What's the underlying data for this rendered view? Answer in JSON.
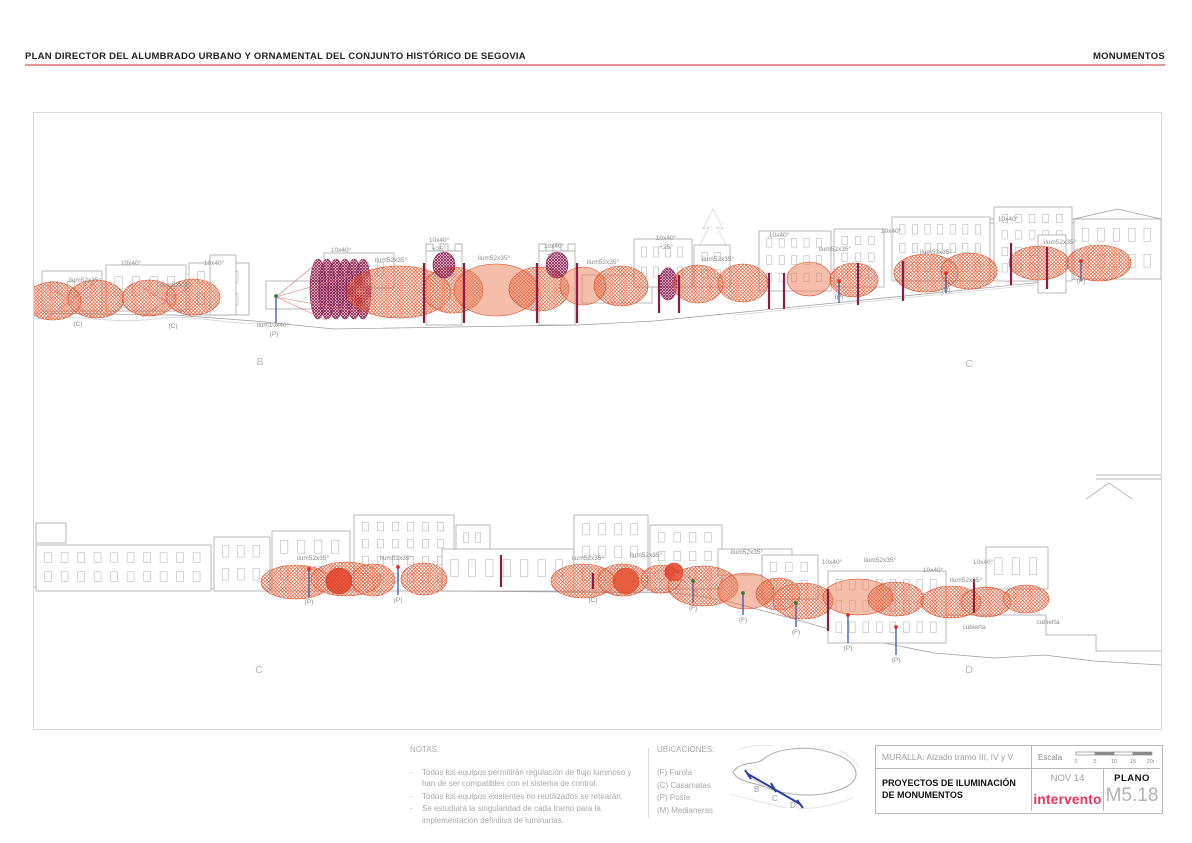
{
  "header": {
    "title": "PLAN DIRECTOR DEL ALUMBRADO URBANO Y ORNAMENTAL DEL CONJUNTO HISTÓRICO DE SEGOVIA",
    "right": "MONUMENTOS"
  },
  "footer": {
    "notas": {
      "title": "NOTAS:",
      "bullet": "-",
      "items": [
        "Todos los equipos permitirán regulación de flujo luminoso y han de ser compatibles con el sistema de control.",
        "Todos los equipos existentes no reutilizados se retirarán.",
        "Se estudiará la singularidad de cada tramo para la implementación definitiva de luminarias."
      ]
    },
    "ubicaciones": {
      "title": "UBICACIONES:",
      "items": [
        "(F) Farola",
        "(C) Casamatas",
        "(P) Poste",
        "(M) Medianeras"
      ],
      "map_labels": [
        "B",
        "C",
        "D"
      ]
    },
    "titleblock": {
      "subtitle": "MURALLA: Alzado tramo III, IV y V",
      "escala_label": "Escala",
      "scale_ticks": [
        "0",
        "5",
        "10",
        "15",
        "20m"
      ],
      "project": "PROYECTOS DE ILUMINACIÓN DE MONUMENTOS",
      "date": "NOV 14",
      "logo": "intervento",
      "plano_label": "PLANO",
      "plano_number": "M5.18"
    }
  },
  "drawing": {
    "colors": {
      "line": "#9c9c9c",
      "light": "#cfcfcf",
      "label": "#8a8a8a",
      "letter": "#b8b8b8",
      "maroon": "#8e1b41",
      "blue": "#3a57a8",
      "green": "#2e7d32",
      "red": "#d83025",
      "redline": "#e57373"
    },
    "styles": {
      "h": {
        "f": "url(#hatchO)",
        "s": "#da4b27",
        "o": 1
      },
      "f": {
        "f": "#ef7c57",
        "s": "#da4b27",
        "o": 0.5
      },
      "p": {
        "f": "url(#hatchP)",
        "s": "#8d2050",
        "o": 1
      },
      "r": {
        "f": "#e04027",
        "s": "#c43a22",
        "o": 0.85
      }
    },
    "panel1": {
      "light": [
        "M2,206 C40,200 80,212 120,206 C160,200 200,214 240,210",
        "M700,202 C800,192 900,182 1000,172",
        "M679,96 L669,116 L675,114 L665,134 L672,132 L662,152 L670,150 L660,170 L698,170 L688,150 L696,152 L686,132 L693,134 L683,114 L689,116 Z"
      ],
      "paths": [
        "M0,200 L140,202 L220,208 L260,212 L300,216 L420,214 L545,212 L620,208 L700,200 L800,190 L900,180 L1000,170 L1127,158",
        "M917,106 L1127,106 M917,110 L1127,110",
        "M392,138 v-7 h7 v7 h7 v-7 h8 v7 h7 v-7 h7 v7",
        "M505,138 v-7 h7 v7 h7 v-7 h8 v7 h7 v-7 h7 v7",
        "M556,162 v28 M566,162 v28 M576,162 v28 M586,162 v28 M596,162 v28 M606,162 v28"
      ],
      "buildings": [
        [
          8,
          158,
          60,
          40,
          1,
          3
        ],
        [
          72,
          152,
          80,
          46,
          1,
          4
        ],
        [
          155,
          150,
          60,
          52,
          2,
          3
        ],
        [
          176,
          142,
          26,
          60,
          0,
          0
        ],
        [
          232,
          168,
          55,
          28,
          0,
          0
        ],
        [
          290,
          140,
          70,
          35,
          1,
          4
        ],
        [
          392,
          138,
          36,
          74,
          0,
          0
        ],
        [
          505,
          138,
          36,
          74,
          0,
          0
        ],
        [
          548,
          162,
          70,
          28,
          0,
          0
        ],
        [
          600,
          126,
          58,
          48,
          2,
          4
        ],
        [
          660,
          132,
          36,
          42,
          2,
          2
        ],
        [
          725,
          118,
          72,
          60,
          3,
          5
        ],
        [
          800,
          116,
          50,
          58,
          3,
          3
        ],
        [
          858,
          104,
          98,
          64,
          3,
          7
        ],
        [
          960,
          94,
          78,
          74,
          4,
          5
        ],
        [
          1004,
          122,
          28,
          58,
          0,
          0
        ],
        [
          1040,
          106,
          87,
          60,
          2,
          5,
          10
        ]
      ],
      "ellipses": [
        [
          19,
          188,
          28,
          19,
          "h"
        ],
        [
          62,
          186,
          28,
          19,
          "h"
        ],
        [
          115,
          185,
          27,
          18,
          "h"
        ],
        [
          159,
          184,
          27,
          18,
          "h"
        ],
        [
          284,
          176,
          8,
          30,
          "p"
        ],
        [
          293,
          176,
          8,
          30,
          "p"
        ],
        [
          302,
          176,
          8,
          30,
          "p"
        ],
        [
          311,
          176,
          8,
          30,
          "p"
        ],
        [
          320,
          176,
          8,
          30,
          "p"
        ],
        [
          329,
          176,
          8,
          30,
          "p"
        ],
        [
          365,
          179,
          52,
          26,
          "h"
        ],
        [
          419,
          177,
          30,
          23,
          "h"
        ],
        [
          462,
          177,
          42,
          26,
          "f"
        ],
        [
          505,
          176,
          30,
          22,
          "h"
        ],
        [
          410,
          152,
          11,
          13,
          "p"
        ],
        [
          523,
          152,
          11,
          13,
          "p"
        ],
        [
          549,
          173,
          23,
          19,
          "f"
        ],
        [
          587,
          173,
          27,
          20,
          "h"
        ],
        [
          634,
          171,
          9,
          16,
          "p"
        ],
        [
          664,
          171,
          25,
          19,
          "h"
        ],
        [
          709,
          170,
          25,
          19,
          "h"
        ],
        [
          775,
          166,
          22,
          17,
          "f"
        ],
        [
          820,
          167,
          24,
          17,
          "h"
        ],
        [
          892,
          160,
          32,
          19,
          "h"
        ],
        [
          935,
          158,
          28,
          18,
          "h"
        ],
        [
          1005,
          150,
          30,
          17,
          "h"
        ],
        [
          1065,
          150,
          32,
          18,
          "h"
        ]
      ],
      "redlines": [
        [
          13,
          205,
          60,
          170
        ],
        [
          60,
          205,
          13,
          172
        ],
        [
          108,
          204,
          158,
          172
        ],
        [
          158,
          204,
          108,
          174
        ],
        [
          242,
          184,
          283,
          150
        ],
        [
          242,
          184,
          292,
          207
        ],
        [
          242,
          184,
          318,
          162
        ],
        [
          242,
          184,
          330,
          200
        ]
      ],
      "posts": [
        [
          390,
          150,
          210,
          "maroon"
        ],
        [
          430,
          150,
          210,
          "maroon"
        ],
        [
          503,
          150,
          210,
          "maroon"
        ],
        [
          543,
          150,
          210,
          "maroon"
        ],
        [
          625,
          162,
          200,
          "maroon"
        ],
        [
          645,
          162,
          200,
          "maroon"
        ],
        [
          735,
          160,
          196,
          "maroon"
        ],
        [
          750,
          160,
          196,
          "maroon"
        ],
        [
          824,
          150,
          192,
          "maroon"
        ],
        [
          869,
          148,
          188,
          "maroon"
        ],
        [
          977,
          130,
          172,
          "maroon"
        ],
        [
          1013,
          134,
          176,
          "maroon"
        ],
        [
          242,
          183,
          210,
          "blue",
          "green"
        ],
        [
          805,
          168,
          190,
          "blue",
          "red"
        ],
        [
          912,
          160,
          180,
          "blue",
          "red"
        ],
        [
          1047,
          148,
          168,
          "blue",
          "red"
        ]
      ],
      "labels": [
        {
          "t": "ilum52x35°",
          "x": 51,
          "y": 169
        },
        {
          "t": "(C)",
          "x": 44,
          "y": 213
        },
        {
          "t": "10x40°",
          "x": 97,
          "y": 152
        },
        {
          "t": "ilum52x35°",
          "x": 142,
          "y": 174
        },
        {
          "t": "(C)",
          "x": 139,
          "y": 215
        },
        {
          "t": "10x40°",
          "x": 180,
          "y": 152
        },
        {
          "t": "ilum10x40°",
          "x": 239,
          "y": 214
        },
        {
          "t": "(P)",
          "x": 240,
          "y": 223
        },
        {
          "t": "10x40°",
          "x": 307,
          "y": 139
        },
        {
          "t": "ilum52x35°",
          "x": 357,
          "y": 149
        },
        {
          "t": "10x40°",
          "x": 405,
          "y": 129
        },
        {
          "t": "+25°",
          "x": 405,
          "y": 138
        },
        {
          "t": "ilum52x35°",
          "x": 460,
          "y": 147
        },
        {
          "t": "10x40°",
          "x": 520,
          "y": 135
        },
        {
          "t": "+25°",
          "x": 520,
          "y": 144
        },
        {
          "t": "ilum52x35°",
          "x": 569,
          "y": 151
        },
        {
          "t": "10x40°",
          "x": 632,
          "y": 127
        },
        {
          "t": "+25°",
          "x": 632,
          "y": 136
        },
        {
          "t": "ilum52x35°",
          "x": 684,
          "y": 148
        },
        {
          "t": "10x40°",
          "x": 745,
          "y": 124
        },
        {
          "t": "ilum52x35°",
          "x": 801,
          "y": 138
        },
        {
          "t": "(P)",
          "x": 805,
          "y": 186
        },
        {
          "t": "10x40°",
          "x": 857,
          "y": 120
        },
        {
          "t": "ilum52x35°",
          "x": 902,
          "y": 141
        },
        {
          "t": "(P)",
          "x": 912,
          "y": 179
        },
        {
          "t": "10x40°",
          "x": 974,
          "y": 108
        },
        {
          "t": "ilum52x35°",
          "x": 1026,
          "y": 131
        },
        {
          "t": "(P)",
          "x": 1047,
          "y": 170
        }
      ],
      "letters": [
        {
          "t": "B",
          "x": 226,
          "y": 252
        },
        {
          "t": "C",
          "x": 935,
          "y": 254
        }
      ]
    },
    "panel2": {
      "light": [
        "M4,176 C30,168 60,180 90,172 C120,166 150,180 178,174",
        "M240,182 C270,174 300,186 330,180",
        "M540,182 C560,176 580,186 600,180"
      ],
      "paths": [
        "M0,184 L200,186 L420,188 L640,190 L665,193 L700,200 L760,216 L830,236 L900,250 L960,255 L1010,252 L1060,258 L1127,262",
        "M420,152 v30 M436,152 v30 M452,152 v30 M468,152 v30 M484,152 v30 M500,152 v30 M516,152 v30",
        "M692,146 v26 M702,146 v26 M712,146 v26 M722,146 v26 M732,146 v26 M742,146 v26 M752,146 v26",
        "M878,212 L1012,212 M1012,212 L1012,232 L1062,232 L1062,248 L1127,248",
        "M1062,72 L1127,72 M1062,76 L1127,76",
        "M1052,96 L1075,80 L1098,96"
      ],
      "buildings": [
        [
          2,
          120,
          30,
          20,
          0,
          0
        ],
        [
          2,
          142,
          175,
          46,
          2,
          10
        ],
        [
          180,
          134,
          56,
          54,
          2,
          3
        ],
        [
          238,
          128,
          78,
          60,
          2,
          4
        ],
        [
          320,
          112,
          100,
          76,
          4,
          6
        ],
        [
          422,
          122,
          34,
          66,
          3,
          2
        ],
        [
          408,
          146,
          132,
          42,
          1,
          7
        ],
        [
          540,
          112,
          74,
          76,
          3,
          4
        ],
        [
          616,
          122,
          72,
          64,
          3,
          4
        ],
        [
          684,
          146,
          74,
          26,
          0,
          0
        ],
        [
          728,
          152,
          56,
          44,
          2,
          3
        ],
        [
          794,
          168,
          118,
          72,
          3,
          8
        ],
        [
          952,
          144,
          62,
          42,
          1,
          3
        ]
      ],
      "ellipses": [
        [
          262,
          179,
          35,
          17,
          "h"
        ],
        [
          312,
          176,
          35,
          17,
          "h"
        ],
        [
          305,
          178,
          13,
          13,
          "r"
        ],
        [
          339,
          177,
          22,
          16,
          "h"
        ],
        [
          390,
          176,
          23,
          16,
          "h"
        ],
        [
          549,
          178,
          32,
          17,
          "h"
        ],
        [
          592,
          178,
          13,
          13,
          "r"
        ],
        [
          589,
          177,
          25,
          16,
          "h"
        ],
        [
          627,
          176,
          20,
          14,
          "h"
        ],
        [
          640,
          169,
          9,
          9,
          "r"
        ],
        [
          669,
          183,
          35,
          20,
          "h"
        ],
        [
          712,
          188,
          28,
          18,
          "f"
        ],
        [
          744,
          191,
          22,
          16,
          "h"
        ],
        [
          769,
          198,
          30,
          18,
          "h"
        ],
        [
          824,
          194,
          35,
          18,
          "f"
        ],
        [
          862,
          196,
          28,
          17,
          "h"
        ],
        [
          917,
          199,
          30,
          16,
          "h"
        ],
        [
          952,
          199,
          25,
          15,
          "h"
        ],
        [
          992,
          196,
          23,
          14,
          "h"
        ]
      ],
      "redlines": [
        [
          640,
          170,
          668,
          178
        ],
        [
          640,
          170,
          664,
          190
        ]
      ],
      "posts": [
        [
          467,
          152,
          184,
          "maroon"
        ],
        [
          559,
          170,
          186,
          "maroon"
        ],
        [
          794,
          186,
          228,
          "maroon"
        ],
        [
          940,
          176,
          210,
          "maroon"
        ],
        [
          275,
          166,
          194,
          "blue",
          "red"
        ],
        [
          364,
          164,
          192,
          "blue",
          "red"
        ],
        [
          659,
          178,
          200,
          "blue",
          "green"
        ],
        [
          709,
          190,
          212,
          "blue",
          "green"
        ],
        [
          762,
          200,
          224,
          "blue",
          "green"
        ],
        [
          814,
          212,
          240,
          "blue",
          "red"
        ],
        [
          862,
          224,
          252,
          "blue",
          "red"
        ]
      ],
      "labels": [
        {
          "t": "ilum52x35°",
          "x": 279,
          "y": 157
        },
        {
          "t": "(P)",
          "x": 275,
          "y": 201
        },
        {
          "t": "ilum52x35°",
          "x": 362,
          "y": 157
        },
        {
          "t": "(P)",
          "x": 364,
          "y": 199
        },
        {
          "t": "ilum52x35°",
          "x": 554,
          "y": 157
        },
        {
          "t": "(C)",
          "x": 559,
          "y": 199
        },
        {
          "t": "ilum52x35°",
          "x": 612,
          "y": 154
        },
        {
          "t": "ilum52x35°",
          "x": 713,
          "y": 151
        },
        {
          "t": "(F)",
          "x": 659,
          "y": 207
        },
        {
          "t": "(F)",
          "x": 709,
          "y": 219
        },
        {
          "t": "(F)",
          "x": 762,
          "y": 231
        },
        {
          "t": "10x40°",
          "x": 798,
          "y": 161
        },
        {
          "t": "ilum52x35°",
          "x": 846,
          "y": 159
        },
        {
          "t": "(P)",
          "x": 814,
          "y": 247
        },
        {
          "t": "(P)",
          "x": 862,
          "y": 259
        },
        {
          "t": "10x40°",
          "x": 899,
          "y": 169
        },
        {
          "t": "ilum52x35°",
          "x": 932,
          "y": 179
        },
        {
          "t": "10x40°",
          "x": 949,
          "y": 161
        },
        {
          "t": "cubierta",
          "x": 940,
          "y": 226
        },
        {
          "t": "cubierta",
          "x": 1014,
          "y": 221
        }
      ],
      "letters": [
        {
          "t": "C",
          "x": 225,
          "y": 270
        },
        {
          "t": "D",
          "x": 935,
          "y": 270
        }
      ]
    }
  }
}
